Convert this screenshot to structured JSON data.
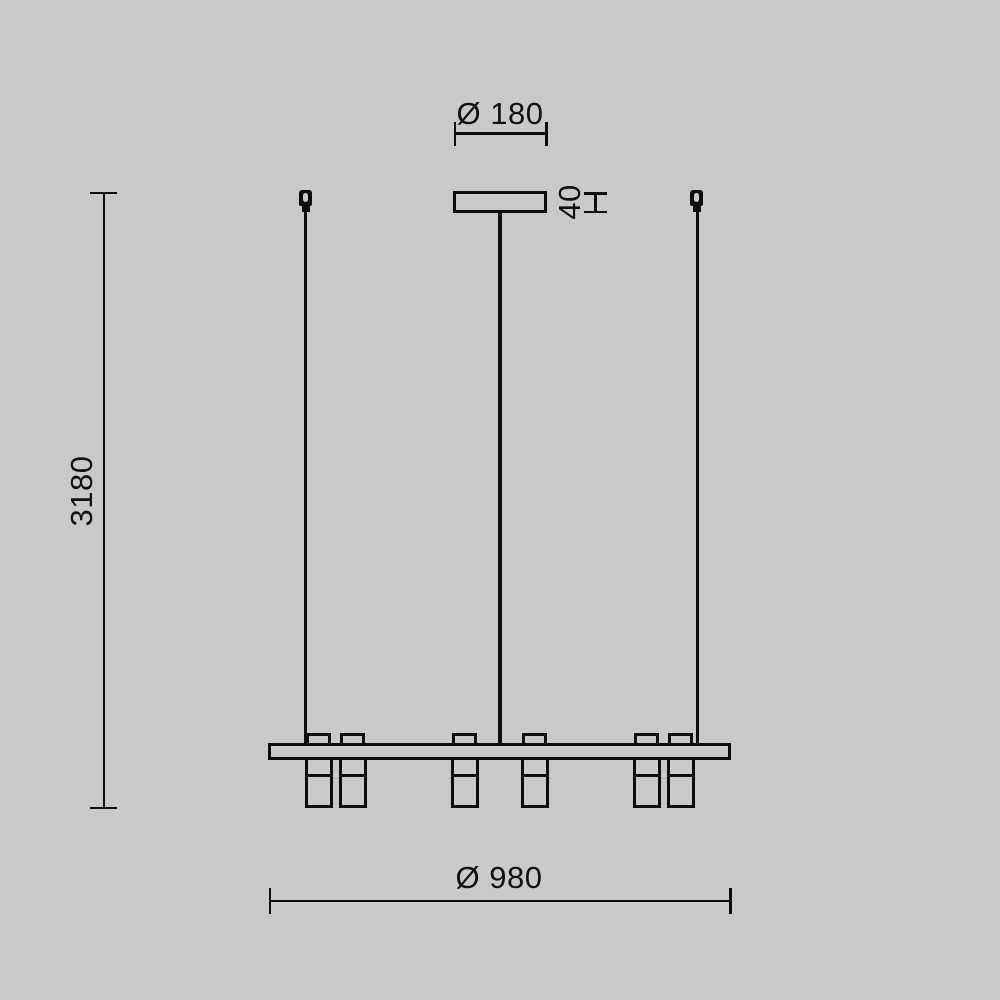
{
  "drawing": {
    "dimensions": {
      "canopy_diameter": "Ø 180",
      "canopy_height": "40",
      "overall_height": "3180",
      "bar_diameter": "Ø 980"
    },
    "colors": {
      "background": "#c8c9ca",
      "line": "#0d0d0d"
    }
  }
}
